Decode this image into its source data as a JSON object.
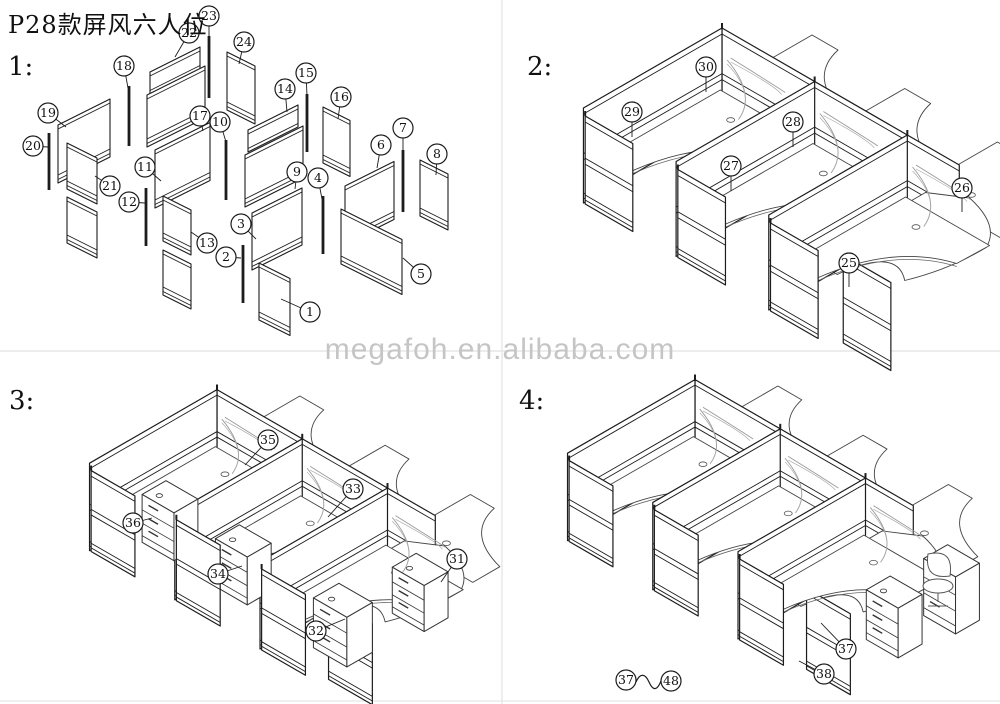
{
  "title": "P28款屏风六人位",
  "watermark": {
    "text": "megafoh.en.alibaba.com",
    "x": 0,
    "y": 333,
    "color": "#c5c5c5"
  },
  "dividers": {
    "v_x": 502,
    "h_y": 351,
    "bottom_y": 701,
    "color": "#e6e6e6"
  },
  "line_color": "#1c1c1c",
  "sections": [
    {
      "id": "1",
      "label": "1:",
      "label_x": 8,
      "label_y": 52,
      "type": "exploded",
      "poles": [
        {
          "x": 129,
          "y1": 86,
          "y2": 146
        },
        {
          "x": 209,
          "y1": 36,
          "y2": 98
        },
        {
          "x": 49,
          "y1": 133,
          "y2": 190
        },
        {
          "x": 226,
          "y1": 140,
          "y2": 200
        },
        {
          "x": 307,
          "y1": 94,
          "y2": 152
        },
        {
          "x": 146,
          "y1": 188,
          "y2": 246
        },
        {
          "x": 243,
          "y1": 245,
          "y2": 303
        },
        {
          "x": 323,
          "y1": 196,
          "y2": 254
        },
        {
          "x": 403,
          "y1": 150,
          "y2": 212
        }
      ],
      "panels": [
        {
          "x": 58,
          "y": 125,
          "w": 52,
          "h": 58,
          "dir": 1
        },
        {
          "x": 67,
          "y": 143,
          "w": 30,
          "h": 46,
          "dir": -1
        },
        {
          "x": 67,
          "y": 197,
          "w": 30,
          "h": 46,
          "dir": -1
        },
        {
          "x": 150,
          "y": 72,
          "w": 50,
          "h": 22,
          "dir": 1
        },
        {
          "x": 147,
          "y": 95,
          "w": 58,
          "h": 52,
          "dir": 1
        },
        {
          "x": 155,
          "y": 150,
          "w": 55,
          "h": 58,
          "dir": 1
        },
        {
          "x": 163,
          "y": 196,
          "w": 28,
          "h": 45,
          "dir": -1
        },
        {
          "x": 163,
          "y": 250,
          "w": 28,
          "h": 45,
          "dir": -1
        },
        {
          "x": 227,
          "y": 52,
          "w": 28,
          "h": 58,
          "dir": -1
        },
        {
          "x": 248,
          "y": 130,
          "w": 50,
          "h": 22,
          "dir": 1
        },
        {
          "x": 245,
          "y": 155,
          "w": 58,
          "h": 52,
          "dir": 1
        },
        {
          "x": 252,
          "y": 213,
          "w": 50,
          "h": 57,
          "dir": 1
        },
        {
          "x": 259,
          "y": 263,
          "w": 31,
          "h": 57,
          "dir": -1
        },
        {
          "x": 323,
          "y": 107,
          "w": 27,
          "h": 56,
          "dir": -1
        },
        {
          "x": 345,
          "y": 186,
          "w": 49,
          "h": 58,
          "dir": 1
        },
        {
          "x": 341,
          "y": 209,
          "w": 61,
          "h": 55,
          "dir": -1
        },
        {
          "x": 420,
          "y": 160,
          "w": 28,
          "h": 56,
          "dir": -1
        }
      ],
      "callouts": [
        {
          "n": "1",
          "cx": 310,
          "cy": 312,
          "tx": 281,
          "ty": 299
        },
        {
          "n": "2",
          "cx": 226,
          "cy": 257,
          "tx": 241,
          "ty": 258
        },
        {
          "n": "3",
          "cx": 241,
          "cy": 224,
          "tx": 256,
          "ty": 239
        },
        {
          "n": "4",
          "cx": 318,
          "cy": 178,
          "tx": 322,
          "ty": 199
        },
        {
          "n": "5",
          "cx": 421,
          "cy": 274,
          "tx": 403,
          "ty": 258
        },
        {
          "n": "6",
          "cx": 381,
          "cy": 145,
          "tx": 377,
          "ty": 168
        },
        {
          "n": "7",
          "cx": 403,
          "cy": 128,
          "tx": 403,
          "ty": 151
        },
        {
          "n": "8",
          "cx": 437,
          "cy": 154,
          "tx": 436,
          "ty": 175
        },
        {
          "n": "9",
          "cx": 297,
          "cy": 172,
          "tx": 295,
          "ty": 189
        },
        {
          "n": "10",
          "cx": 220,
          "cy": 122,
          "tx": 226,
          "ty": 142
        },
        {
          "n": "11",
          "cx": 145,
          "cy": 167,
          "tx": 161,
          "ty": 181
        },
        {
          "n": "12",
          "cx": 129,
          "cy": 202,
          "tx": 145,
          "ty": 203
        },
        {
          "n": "13",
          "cx": 207,
          "cy": 243,
          "tx": 191,
          "ty": 232
        },
        {
          "n": "14",
          "cx": 285,
          "cy": 89,
          "tx": 287,
          "ty": 112
        },
        {
          "n": "15",
          "cx": 306,
          "cy": 73,
          "tx": 307,
          "ty": 96
        },
        {
          "n": "16",
          "cx": 341,
          "cy": 97,
          "tx": 338,
          "ty": 119
        },
        {
          "n": "17",
          "cx": 200,
          "cy": 116,
          "tx": 203,
          "ty": 131
        },
        {
          "n": "18",
          "cx": 124,
          "cy": 66,
          "tx": 128,
          "ty": 88
        },
        {
          "n": "19",
          "cx": 48,
          "cy": 113,
          "tx": 66,
          "ty": 127
        },
        {
          "n": "20",
          "cx": 33,
          "cy": 146,
          "tx": 48,
          "ty": 147
        },
        {
          "n": "21",
          "cx": 110,
          "cy": 186,
          "tx": 95,
          "ty": 176
        },
        {
          "n": "22",
          "cx": 189,
          "cy": 33,
          "tx": 175,
          "ty": 57
        },
        {
          "n": "23",
          "cx": 209,
          "cy": 16,
          "tx": 209,
          "ty": 37
        },
        {
          "n": "24",
          "cx": 244,
          "cy": 42,
          "tx": 239,
          "ty": 64
        }
      ]
    },
    {
      "id": "2",
      "label": "2:",
      "label_x": 527,
      "label_y": 52,
      "type": "cluster",
      "cluster": {
        "ox": 722,
        "oy": 123,
        "s": 1.0,
        "lbay": 107,
        "lcross": 160,
        "wallH": 95,
        "deskH": 40,
        "wingLen": 55,
        "wingH": 88,
        "endDesk": true,
        "endScreen": true
      },
      "pedestals": [],
      "chair": null,
      "legend": null,
      "callouts": [
        {
          "n": "25",
          "cx": 849,
          "cy": 263,
          "tx": 849,
          "ty": 287
        },
        {
          "n": "26",
          "cx": 962,
          "cy": 188,
          "tx": 962,
          "ty": 212
        },
        {
          "n": "27",
          "cx": 731,
          "cy": 166,
          "tx": 731,
          "ty": 191
        },
        {
          "n": "28",
          "cx": 793,
          "cy": 122,
          "tx": 793,
          "ty": 147
        },
        {
          "n": "29",
          "cx": 632,
          "cy": 112,
          "tx": 632,
          "ty": 137
        },
        {
          "n": "30",
          "cx": 706,
          "cy": 67,
          "tx": 706,
          "ty": 92
        }
      ]
    },
    {
      "id": "3",
      "label": "3:",
      "label_x": 9,
      "label_y": 386,
      "type": "cluster",
      "cluster": {
        "ox": 217,
        "oy": 477,
        "s": 0.92,
        "lbay": 107,
        "lcross": 160,
        "wallH": 95,
        "deskH": 40,
        "wingLen": 55,
        "wingH": 88,
        "endDesk": true,
        "endScreen": true
      },
      "pedestals": [
        {
          "u": 24,
          "v": -118,
          "w": 40,
          "d": 30,
          "h": 52
        },
        {
          "u": 118,
          "v": -120,
          "w": 40,
          "d": 30,
          "h": 52
        },
        {
          "u": 246,
          "v": -125,
          "w": 42,
          "d": 32,
          "h": 54
        },
        {
          "u": 258,
          "v": -38,
          "w": 40,
          "d": 30,
          "h": 50
        }
      ],
      "chair": null,
      "legend": null,
      "callouts": [
        {
          "n": "31",
          "cx": 457,
          "cy": 559,
          "tx": 441,
          "ty": 582
        },
        {
          "n": "32",
          "cx": 316,
          "cy": 631,
          "tx": 345,
          "ty": 619
        },
        {
          "n": "33",
          "cx": 353,
          "cy": 489,
          "tx": 328,
          "ty": 517
        },
        {
          "n": "34",
          "cx": 218,
          "cy": 574,
          "tx": 242,
          "ty": 566
        },
        {
          "n": "35",
          "cx": 268,
          "cy": 440,
          "tx": 245,
          "ty": 465
        },
        {
          "n": "36",
          "cx": 133,
          "cy": 523,
          "tx": 152,
          "ty": 518
        }
      ]
    },
    {
      "id": "4",
      "label": "4:",
      "label_x": 519,
      "label_y": 386,
      "type": "cluster",
      "cluster": {
        "ox": 695,
        "oy": 467,
        "s": 0.92,
        "lbay": 107,
        "lcross": 160,
        "wallH": 95,
        "deskH": 40,
        "wingLen": 55,
        "wingH": 88,
        "endDesk": true,
        "endScreen": true
      },
      "pedestals": [
        {
          "u": 295,
          "v": -80,
          "w": 40,
          "d": 30,
          "h": 54
        },
        {
          "u": 305,
          "v": -18,
          "w": 40,
          "d": 30,
          "h": 62
        }
      ],
      "chair": {
        "x": 940,
        "y": 582
      },
      "legend": {
        "a": "37",
        "b": "48",
        "x1": 626,
        "y1": 680,
        "x2": 671,
        "y2": 681
      },
      "callouts": [
        {
          "n": "37",
          "cx": 846,
          "cy": 649,
          "tx": 821,
          "ty": 623
        },
        {
          "n": "38",
          "cx": 824,
          "cy": 674,
          "tx": 799,
          "ty": 661
        }
      ]
    }
  ]
}
